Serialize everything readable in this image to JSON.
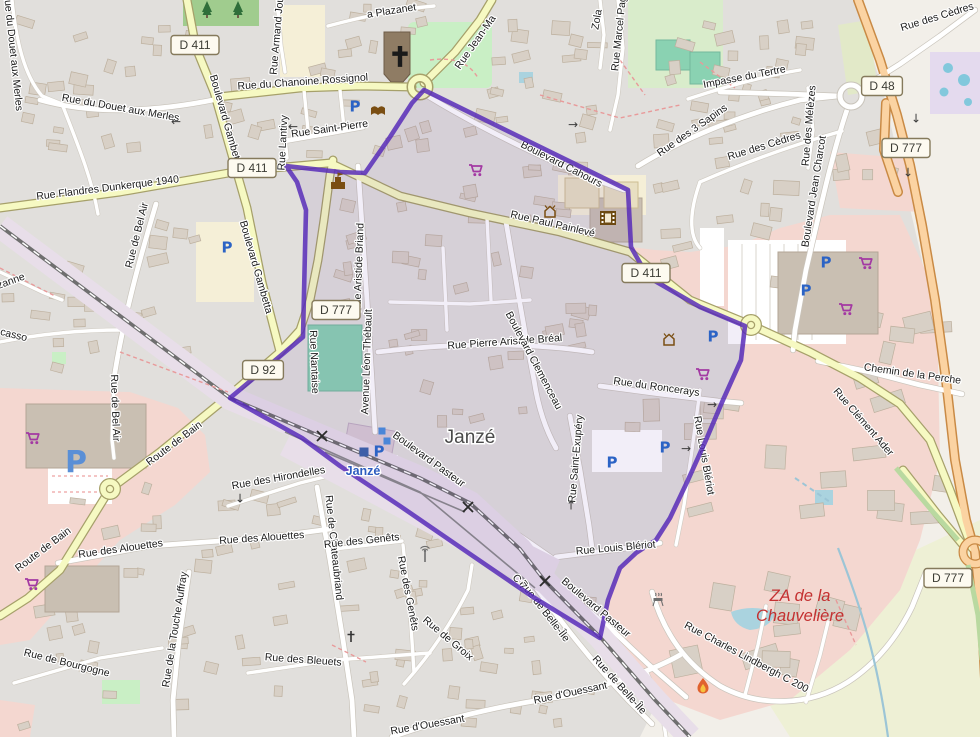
{
  "map": {
    "places": {
      "town": "Janzé",
      "station": "Janzé",
      "zone_line1": "ZA de la",
      "zone_line2": "Chauvelière"
    },
    "colors": {
      "boundary": "#5629b8",
      "residential": "#e1dfdc",
      "retail_pink": "#f4d7d0",
      "road_secondary": "#f6f9c2",
      "road_primary": "#fbd3a2",
      "pitch_green": "#8ad2b2",
      "forest_green": "#a0cc8e",
      "shop_icon": "#a339a3",
      "parking_icon": "#2b63c5",
      "amenity_brown": "#7a4e12",
      "zone_label_red": "#c43131",
      "station_blue": "#2d5cbf"
    },
    "shields": [
      {
        "ref": "D 411",
        "x": 195,
        "y": 45
      },
      {
        "ref": "D 411",
        "x": 252,
        "y": 168
      },
      {
        "ref": "D 48",
        "x": 882,
        "y": 86
      },
      {
        "ref": "D 777",
        "x": 906,
        "y": 148
      },
      {
        "ref": "D 777",
        "x": 336,
        "y": 310
      },
      {
        "ref": "D 92",
        "x": 263,
        "y": 370
      },
      {
        "ref": "D 411",
        "x": 646,
        "y": 273
      },
      {
        "ref": "D 777",
        "x": 948,
        "y": 578
      }
    ],
    "street_labels": [
      {
        "text": "Rue du Douet aux Merles",
        "x": 10,
        "y": 52,
        "rot": 84
      },
      {
        "text": "Rue du Douet aux Merles",
        "x": 120,
        "y": 111,
        "rot": 10
      },
      {
        "text": "Rue Armand Jou",
        "x": 280,
        "y": 36,
        "rot": -85
      },
      {
        "text": "a Plazanet",
        "x": 392,
        "y": 14,
        "rot": -9
      },
      {
        "text": "Rue du Chanoine Rossignol",
        "x": 303,
        "y": 85,
        "rot": -4
      },
      {
        "text": "Rue Saint-Pierre",
        "x": 330,
        "y": 132,
        "rot": -8
      },
      {
        "text": "Rue Jean-Ma",
        "x": 478,
        "y": 44,
        "rot": -55
      },
      {
        "text": "Boulevard Gambetta",
        "x": 223,
        "y": 122,
        "rot": 74
      },
      {
        "text": "Boulevard Gambetta",
        "x": 253,
        "y": 268,
        "rot": 74
      },
      {
        "text": "Rue Lantivy",
        "x": 286,
        "y": 143,
        "rot": -87
      },
      {
        "text": "Rue Flandres Dunkerque 1940",
        "x": 108,
        "y": 191,
        "rot": -7
      },
      {
        "text": "Rue de Bel Air",
        "x": 140,
        "y": 236,
        "rot": -76
      },
      {
        "text": "zanne",
        "x": 12,
        "y": 284,
        "rot": -20
      },
      {
        "text": "casso",
        "x": 13,
        "y": 338,
        "rot": 14
      },
      {
        "text": "Rue Marcel Pag",
        "x": 622,
        "y": 34,
        "rot": -84
      },
      {
        "text": "Zola",
        "x": 600,
        "y": 20,
        "rot": -80
      },
      {
        "text": "Impasse du Tertre",
        "x": 745,
        "y": 80,
        "rot": -11
      },
      {
        "text": "Rue des 3 Sapins",
        "x": 694,
        "y": 133,
        "rot": -35
      },
      {
        "text": "Rue des Cèdres",
        "x": 765,
        "y": 149,
        "rot": -17
      },
      {
        "text": "Rue des Mélèzes",
        "x": 812,
        "y": 126,
        "rot": -85
      },
      {
        "text": "Boulevard Jean Charcot",
        "x": 817,
        "y": 192,
        "rot": -81
      },
      {
        "text": "Rue des Cèdres",
        "x": 938,
        "y": 20,
        "rot": -17
      },
      {
        "text": "Rue Paul Painlevé",
        "x": 552,
        "y": 227,
        "rot": 13
      },
      {
        "text": "Boulevard Cahours",
        "x": 560,
        "y": 167,
        "rot": 27,
        "under": true
      },
      {
        "text": "Rue Aristide Briand",
        "x": 362,
        "y": 268,
        "rot": -88
      },
      {
        "text": "Avenue Léon Thébault",
        "x": 370,
        "y": 362,
        "rot": -88
      },
      {
        "text": "Rue Nantaise",
        "x": 311,
        "y": 362,
        "rot": 88
      },
      {
        "text": "Rue Pierre Aristide Bréal",
        "x": 505,
        "y": 345,
        "rot": -4
      },
      {
        "text": "Boulevard Clemenceau",
        "x": 531,
        "y": 362,
        "rot": 62
      },
      {
        "text": "Rue du Roncerays",
        "x": 656,
        "y": 390,
        "rot": 8
      },
      {
        "text": "Rue Saint-Exupéry",
        "x": 579,
        "y": 459,
        "rot": -85
      },
      {
        "text": "Rue Louis Blériot",
        "x": 616,
        "y": 551,
        "rot": -5
      },
      {
        "text": "Rue Louis Blériot",
        "x": 701,
        "y": 456,
        "rot": 80,
        "under": true
      },
      {
        "text": "Chemin de la Perche",
        "x": 912,
        "y": 377,
        "rot": 8
      },
      {
        "text": "Rue Clément Ader",
        "x": 861,
        "y": 424,
        "rot": 49
      },
      {
        "text": "Route de Bain",
        "x": 176,
        "y": 446,
        "rot": -37
      },
      {
        "text": "Route de Bain",
        "x": 45,
        "y": 552,
        "rot": -37
      },
      {
        "text": "Rue des Hirondelles",
        "x": 279,
        "y": 481,
        "rot": -10
      },
      {
        "text": "Rue des Alouettes",
        "x": 121,
        "y": 552,
        "rot": -8
      },
      {
        "text": "Rue des Alouettes",
        "x": 262,
        "y": 541,
        "rot": -4
      },
      {
        "text": "Rue de Chateaubriand",
        "x": 331,
        "y": 548,
        "rot": 84
      },
      {
        "text": "Rue des Genêts",
        "x": 362,
        "y": 544,
        "rot": -6
      },
      {
        "text": "Rue des Genêts",
        "x": 405,
        "y": 594,
        "rot": 79
      },
      {
        "text": "Rue de la Touche Auffray",
        "x": 178,
        "y": 630,
        "rot": -81
      },
      {
        "text": "Rue de Bourgogne",
        "x": 66,
        "y": 666,
        "rot": 14
      },
      {
        "text": "Rue des Bleuets",
        "x": 303,
        "y": 663,
        "rot": 4
      },
      {
        "text": "Rue de Groix",
        "x": 446,
        "y": 641,
        "rot": 40
      },
      {
        "text": "Rue d'Ouessant",
        "x": 571,
        "y": 696,
        "rot": -12
      },
      {
        "text": "Rue d'Ouessant",
        "x": 428,
        "y": 728,
        "rot": -10
      },
      {
        "text": "Rue de Belle-Île",
        "x": 542,
        "y": 613,
        "rot": 52,
        "under": true
      },
      {
        "text": "C 7",
        "x": 517,
        "y": 584,
        "rot": 52,
        "under": true
      },
      {
        "text": "Rue de Belle-Île",
        "x": 617,
        "y": 687,
        "rot": 48
      },
      {
        "text": "Boulevard Pasteur",
        "x": 427,
        "y": 462,
        "rot": 36
      },
      {
        "text": "Boulevard Pasteur",
        "x": 594,
        "y": 610,
        "rot": 40
      },
      {
        "text": "Rue de Bel Air",
        "x": 112,
        "y": 408,
        "rot": 88
      },
      {
        "text": "Rue Charles Lindbergh  C 200",
        "x": 745,
        "y": 660,
        "rot": 28
      }
    ],
    "icons": [
      {
        "type": "cart",
        "x": 476,
        "y": 171
      },
      {
        "type": "cart",
        "x": 866,
        "y": 264
      },
      {
        "type": "cart",
        "x": 846,
        "y": 310
      },
      {
        "type": "cart",
        "x": 703,
        "y": 375
      },
      {
        "type": "cart",
        "x": 33,
        "y": 439
      },
      {
        "type": "cart",
        "x": 32,
        "y": 585
      },
      {
        "type": "parking",
        "x": 355,
        "y": 106
      },
      {
        "type": "parking",
        "x": 379,
        "y": 451
      },
      {
        "type": "parking",
        "x": 826,
        "y": 262
      },
      {
        "type": "parking",
        "x": 806,
        "y": 290
      },
      {
        "type": "parking",
        "x": 713,
        "y": 336
      },
      {
        "type": "parking",
        "x": 665,
        "y": 447
      },
      {
        "type": "parking",
        "x": 612,
        "y": 462
      },
      {
        "type": "parking-big",
        "x": 76,
        "y": 461
      },
      {
        "type": "parking",
        "x": 227,
        "y": 247
      },
      {
        "type": "book",
        "x": 378,
        "y": 111
      },
      {
        "type": "townhall",
        "x": 338,
        "y": 183
      },
      {
        "type": "church-cross",
        "x": 400,
        "y": 57
      },
      {
        "type": "cinema",
        "x": 608,
        "y": 218
      },
      {
        "type": "house",
        "x": 550,
        "y": 212
      },
      {
        "type": "house",
        "x": 669,
        "y": 340
      },
      {
        "type": "flame",
        "x": 703,
        "y": 686
      },
      {
        "type": "bbq",
        "x": 658,
        "y": 600
      },
      {
        "type": "mast",
        "x": 425,
        "y": 555
      },
      {
        "type": "wcross",
        "x": 351,
        "y": 637
      },
      {
        "type": "xing",
        "x": 322,
        "y": 436
      },
      {
        "type": "xing",
        "x": 468,
        "y": 507
      },
      {
        "type": "xing",
        "x": 545,
        "y": 581
      },
      {
        "type": "platform",
        "x": 382,
        "y": 431
      },
      {
        "type": "platform",
        "x": 387,
        "y": 441
      },
      {
        "type": "platform-dark",
        "x": 364,
        "y": 452
      },
      {
        "type": "arrow-left",
        "x": 176,
        "y": 121
      },
      {
        "type": "arrow-left",
        "x": 293,
        "y": 126
      },
      {
        "type": "arrow-right",
        "x": 573,
        "y": 124
      },
      {
        "type": "arrow-right",
        "x": 712,
        "y": 404
      },
      {
        "type": "arrow-up",
        "x": 571,
        "y": 505
      },
      {
        "type": "arrow-down",
        "x": 240,
        "y": 498
      },
      {
        "type": "arrow-right",
        "x": 686,
        "y": 448
      },
      {
        "type": "arrow-down",
        "x": 916,
        "y": 118
      },
      {
        "type": "arrow-down",
        "x": 908,
        "y": 172
      },
      {
        "type": "tree",
        "x": 207,
        "y": 10
      },
      {
        "type": "tree",
        "x": 238,
        "y": 10
      }
    ]
  }
}
